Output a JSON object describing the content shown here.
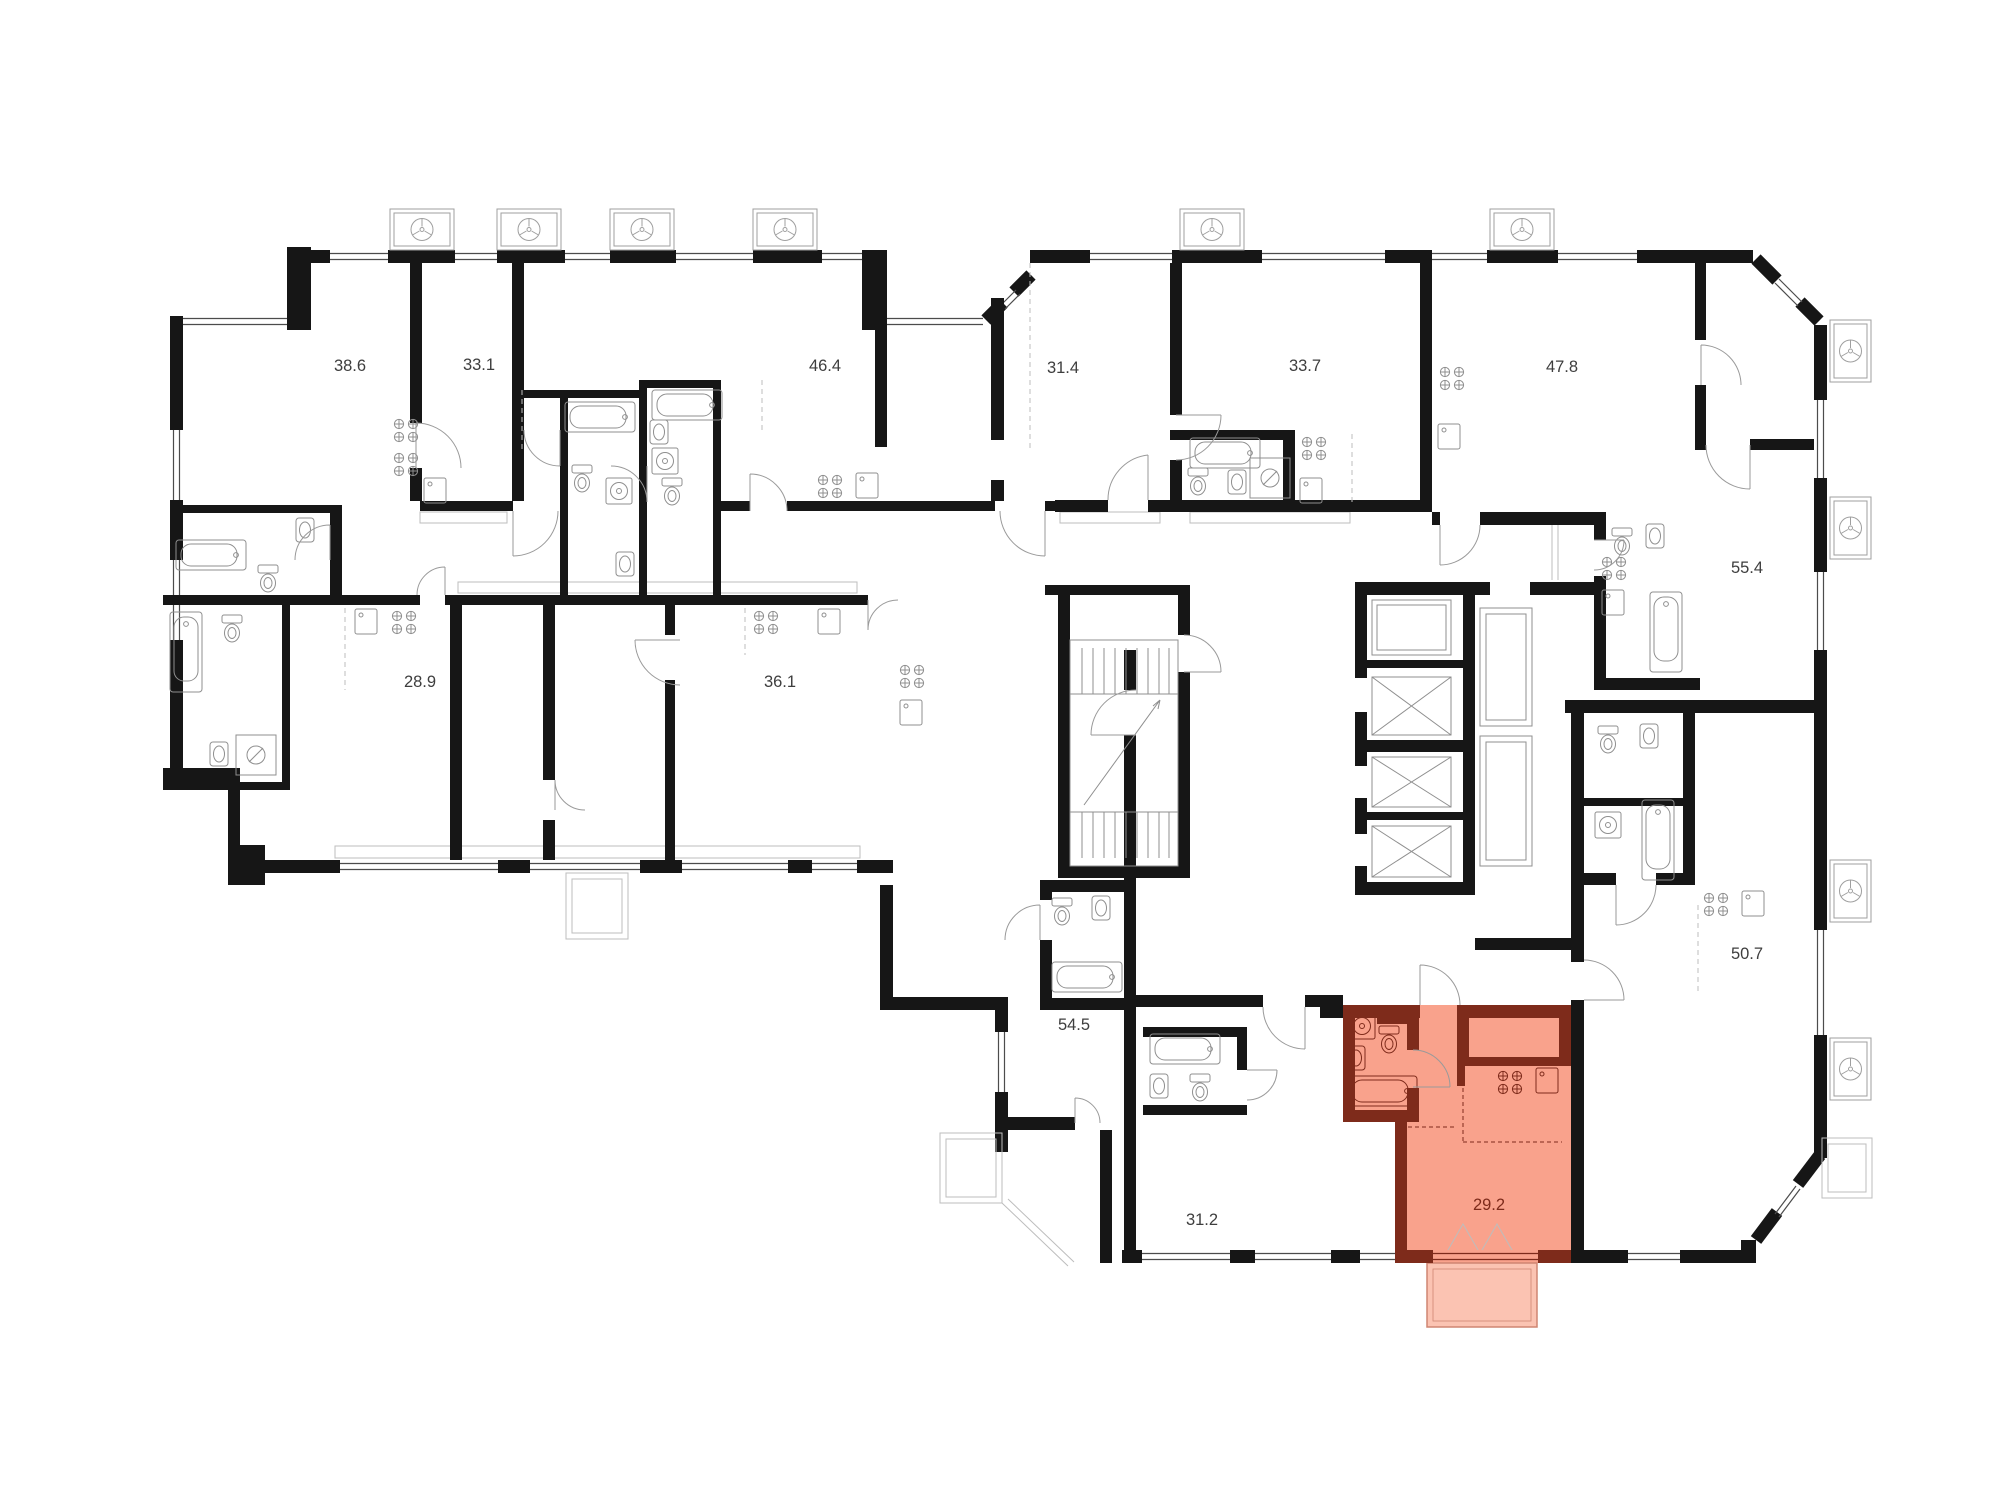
{
  "plan": {
    "type": "architectural-floor-plan",
    "canvas": {
      "width": 2000,
      "height": 1500,
      "background": "#ffffff"
    },
    "colors": {
      "wall": "#161616",
      "thin": "#8f8f8f",
      "light": "#bdbdbd",
      "label": "#3e3e3e",
      "hlf": "#F9A28C",
      "hlw": "#7E2B1B",
      "hlb": "#FBC3B2"
    },
    "highlighted_unit": {
      "label": "29.2",
      "note": "selected apartment with balcony"
    },
    "units": [
      {
        "id": "38-6",
        "label": "38.6",
        "x": 350,
        "y": 371,
        "highlighted": false
      },
      {
        "id": "33-1",
        "label": "33.1",
        "x": 479,
        "y": 370,
        "highlighted": false
      },
      {
        "id": "46-4",
        "label": "46.4",
        "x": 825,
        "y": 371,
        "highlighted": false
      },
      {
        "id": "31-4",
        "label": "31.4",
        "x": 1063,
        "y": 373,
        "highlighted": false
      },
      {
        "id": "33-7",
        "label": "33.7",
        "x": 1305,
        "y": 371,
        "highlighted": false
      },
      {
        "id": "47-8",
        "label": "47.8",
        "x": 1562,
        "y": 372,
        "highlighted": false
      },
      {
        "id": "55-4",
        "label": "55.4",
        "x": 1747,
        "y": 573,
        "highlighted": false
      },
      {
        "id": "28-9",
        "label": "28.9",
        "x": 420,
        "y": 687,
        "highlighted": false
      },
      {
        "id": "36-1",
        "label": "36.1",
        "x": 780,
        "y": 687,
        "highlighted": false
      },
      {
        "id": "54-5",
        "label": "54.5",
        "x": 1074,
        "y": 1030,
        "highlighted": false
      },
      {
        "id": "31-2",
        "label": "31.2",
        "x": 1202,
        "y": 1225,
        "highlighted": false
      },
      {
        "id": "29-2",
        "label": "29.2",
        "x": 1489,
        "y": 1210,
        "highlighted": true
      },
      {
        "id": "50-7",
        "label": "50.7",
        "x": 1747,
        "y": 959,
        "highlighted": false
      }
    ]
  }
}
